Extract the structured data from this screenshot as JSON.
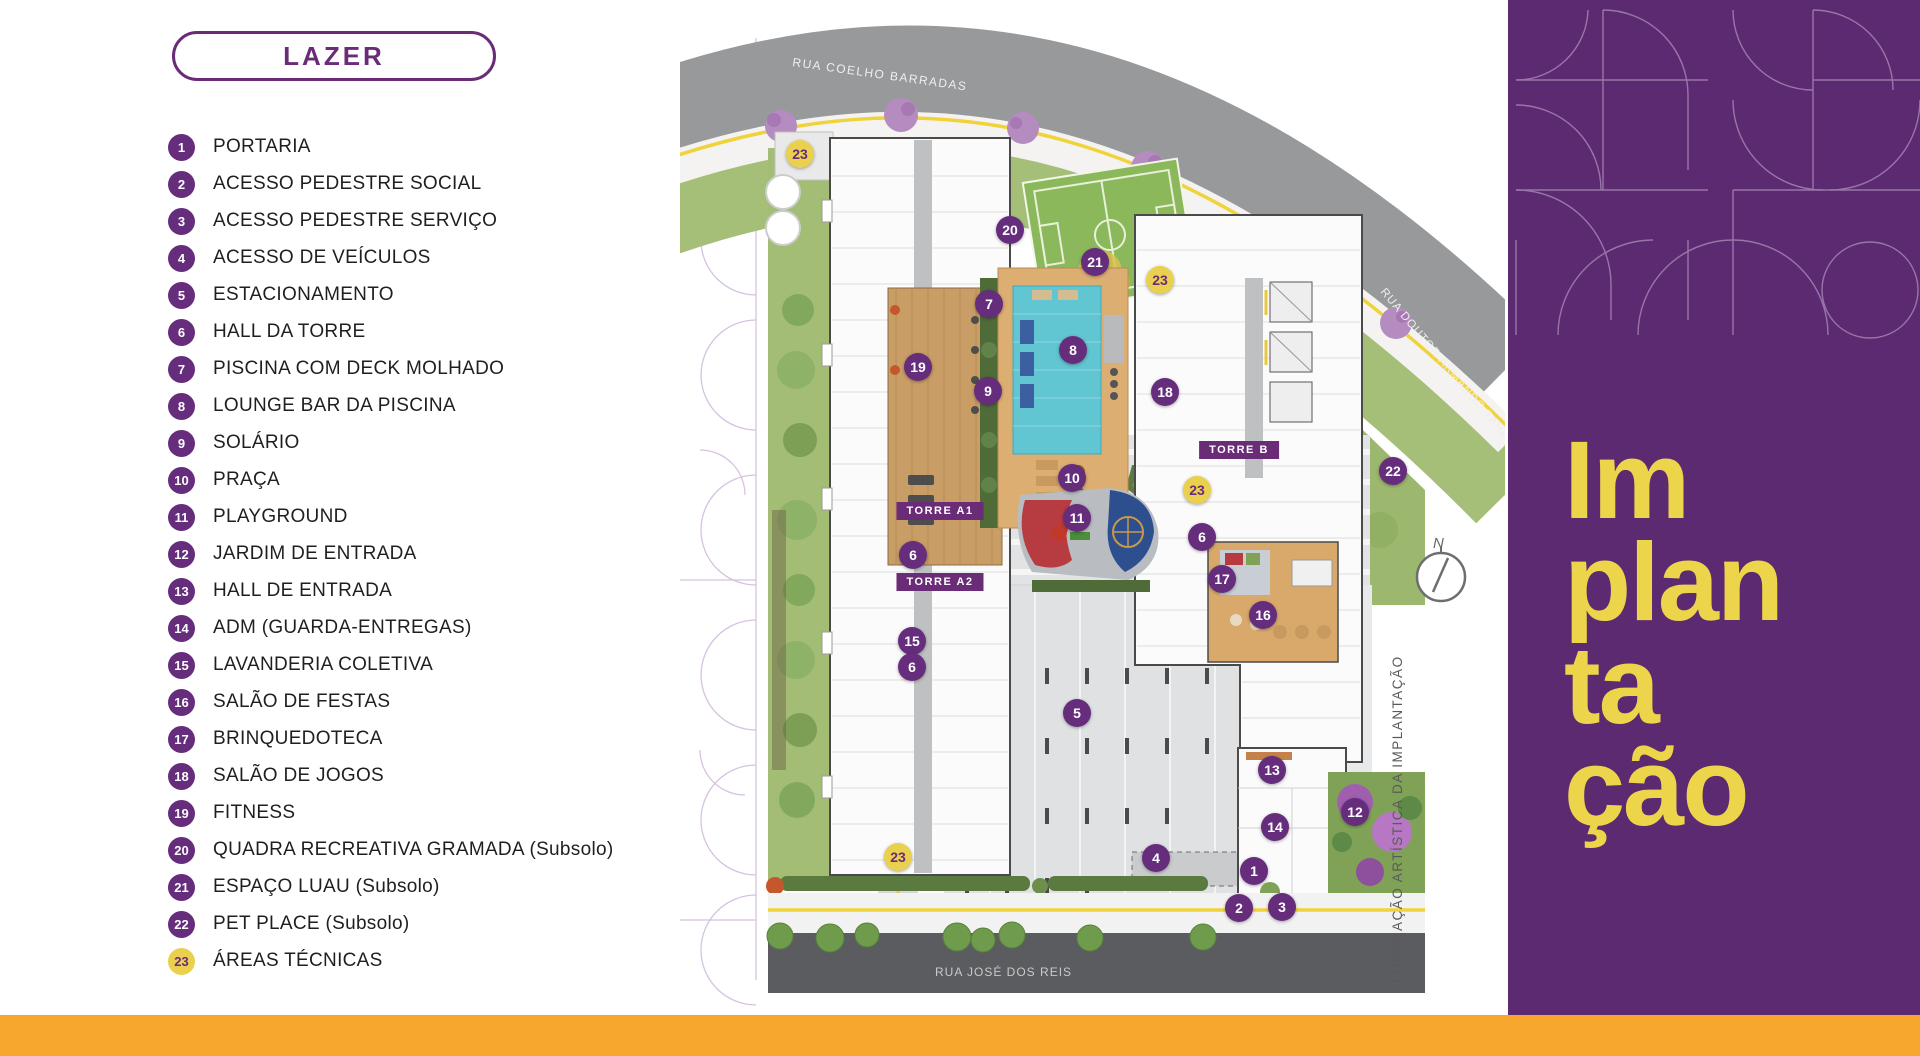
{
  "theme": {
    "accent": "#6a2b77",
    "badge_purple": "#662d7d",
    "panel_purple": "#5c2a70",
    "marker_yellow": "#ead04f",
    "title_yellow": "#edd54b",
    "bar_orange": "#f7a72e"
  },
  "legend": {
    "title": "LAZER",
    "items": [
      {
        "n": "1",
        "label": "PORTARIA",
        "badge": "purple"
      },
      {
        "n": "2",
        "label": "ACESSO PEDESTRE SOCIAL",
        "badge": "purple"
      },
      {
        "n": "3",
        "label": "ACESSO PEDESTRE SERVIÇO",
        "badge": "purple"
      },
      {
        "n": "4",
        "label": "ACESSO DE VEÍCULOS",
        "badge": "purple"
      },
      {
        "n": "5",
        "label": "ESTACIONAMENTO",
        "badge": "purple"
      },
      {
        "n": "6",
        "label": "HALL DA TORRE",
        "badge": "purple"
      },
      {
        "n": "7",
        "label": "PISCINA COM DECK MOLHADO",
        "badge": "purple"
      },
      {
        "n": "8",
        "label": "LOUNGE BAR DA PISCINA",
        "badge": "purple"
      },
      {
        "n": "9",
        "label": "SOLÁRIO",
        "badge": "purple"
      },
      {
        "n": "10",
        "label": "PRAÇA",
        "badge": "purple"
      },
      {
        "n": "11",
        "label": "PLAYGROUND",
        "badge": "purple"
      },
      {
        "n": "12",
        "label": "JARDIM DE ENTRADA",
        "badge": "purple"
      },
      {
        "n": "13",
        "label": "HALL DE ENTRADA",
        "badge": "purple"
      },
      {
        "n": "14",
        "label": "ADM (GUARDA-ENTREGAS)",
        "badge": "purple"
      },
      {
        "n": "15",
        "label": "LAVANDERIA COLETIVA",
        "badge": "purple"
      },
      {
        "n": "16",
        "label": "SALÃO DE FESTAS",
        "badge": "purple"
      },
      {
        "n": "17",
        "label": "BRINQUEDOTECA",
        "badge": "purple"
      },
      {
        "n": "18",
        "label": "SALÃO DE JOGOS",
        "badge": "purple"
      },
      {
        "n": "19",
        "label": "FITNESS",
        "badge": "purple"
      },
      {
        "n": "20",
        "label": "QUADRA RECREATIVA GRAMADA (Subsolo)",
        "badge": "purple"
      },
      {
        "n": "21",
        "label": "ESPAÇO LUAU (Subsolo)",
        "badge": "purple"
      },
      {
        "n": "22",
        "label": "PET PLACE (Subsolo)",
        "badge": "purple"
      },
      {
        "n": "23",
        "label": "ÁREAS TÉCNICAS",
        "badge": "yellow"
      }
    ]
  },
  "map": {
    "caption": "ILUSTRAÇÃO ARTÍSTICA DA IMPLANTAÇÃO",
    "compass_label": "N",
    "streets": [
      {
        "name": "RUA COELHO BARRADAS"
      },
      {
        "name": "RUA DOUTOR ARMANDO TARANTINO"
      },
      {
        "name": "RUA JOSÉ DOS REIS"
      }
    ],
    "towers": [
      {
        "label": "TORRE A1",
        "x": 260,
        "y": 491
      },
      {
        "label": "TORRE A2",
        "x": 260,
        "y": 562
      },
      {
        "label": "TORRE B",
        "x": 559,
        "y": 430
      }
    ],
    "markers": [
      {
        "n": "23",
        "x": 120,
        "y": 134,
        "c": "y"
      },
      {
        "n": "20",
        "x": 330,
        "y": 210,
        "c": "p"
      },
      {
        "n": "21",
        "x": 415,
        "y": 242,
        "c": "p"
      },
      {
        "n": "23",
        "x": 480,
        "y": 260,
        "c": "y"
      },
      {
        "n": "7",
        "x": 309,
        "y": 284,
        "c": "p"
      },
      {
        "n": "8",
        "x": 393,
        "y": 330,
        "c": "p"
      },
      {
        "n": "19",
        "x": 238,
        "y": 347,
        "c": "p"
      },
      {
        "n": "9",
        "x": 308,
        "y": 371,
        "c": "p"
      },
      {
        "n": "18",
        "x": 485,
        "y": 372,
        "c": "p"
      },
      {
        "n": "22",
        "x": 713,
        "y": 451,
        "c": "p"
      },
      {
        "n": "10",
        "x": 392,
        "y": 458,
        "c": "p"
      },
      {
        "n": "23",
        "x": 517,
        "y": 470,
        "c": "y"
      },
      {
        "n": "11",
        "x": 397,
        "y": 498,
        "c": "p"
      },
      {
        "n": "6",
        "x": 522,
        "y": 517,
        "c": "p"
      },
      {
        "n": "6",
        "x": 233,
        "y": 535,
        "c": "p"
      },
      {
        "n": "17",
        "x": 542,
        "y": 559,
        "c": "p"
      },
      {
        "n": "16",
        "x": 583,
        "y": 595,
        "c": "p"
      },
      {
        "n": "15",
        "x": 232,
        "y": 621,
        "c": "p"
      },
      {
        "n": "6",
        "x": 232,
        "y": 647,
        "c": "p"
      },
      {
        "n": "5",
        "x": 397,
        "y": 693,
        "c": "p"
      },
      {
        "n": "13",
        "x": 592,
        "y": 750,
        "c": "p"
      },
      {
        "n": "12",
        "x": 675,
        "y": 792,
        "c": "p"
      },
      {
        "n": "14",
        "x": 595,
        "y": 807,
        "c": "p"
      },
      {
        "n": "23",
        "x": 218,
        "y": 837,
        "c": "y"
      },
      {
        "n": "4",
        "x": 476,
        "y": 838,
        "c": "p"
      },
      {
        "n": "1",
        "x": 574,
        "y": 851,
        "c": "p"
      },
      {
        "n": "2",
        "x": 559,
        "y": 888,
        "c": "p"
      },
      {
        "n": "3",
        "x": 602,
        "y": 887,
        "c": "p"
      }
    ]
  },
  "panel": {
    "title_lines": [
      "Im",
      "plan",
      "ta",
      "ção"
    ]
  }
}
